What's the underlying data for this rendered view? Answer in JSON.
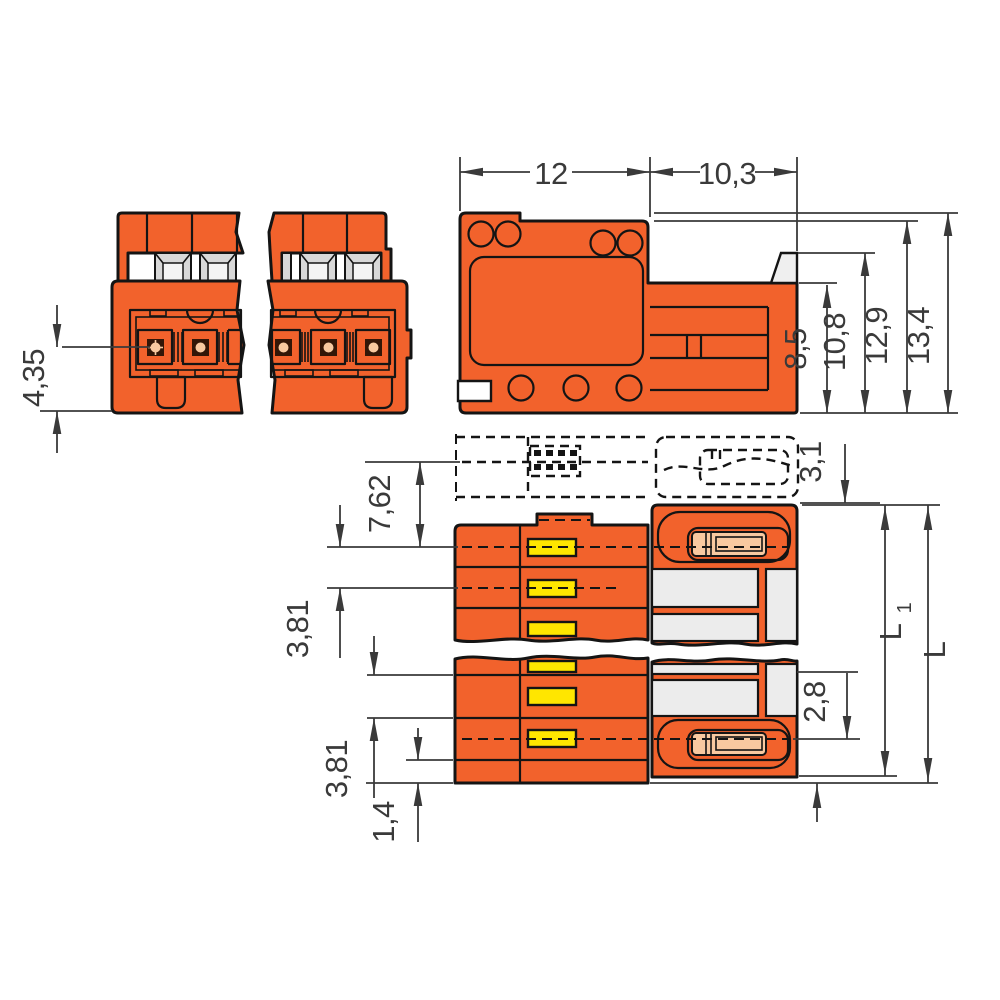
{
  "drawing": {
    "title": "Pluggable connector dimensional drawing",
    "dims": {
      "front_pin_depth": "4,35",
      "housing_width": "12",
      "extension_width": "10,3",
      "height_1": "8,5",
      "height_2": "10,8",
      "height_3": "12,9",
      "height_4": "13,4",
      "mating_clearance": "3,1",
      "edge_to_first_pole": "7,62",
      "pole_pitch_upper": "3,81",
      "pole_pitch_lower": "3,81",
      "foot_height": "1,4",
      "pin_offset": "2,8",
      "length_l1": "L",
      "length_l1_sub": "1",
      "length_l": "L"
    },
    "colors": {
      "body_orange": "#F2622C",
      "contact_yellow": "#FFE600",
      "pin_salmon": "#F8C9A0",
      "slot_gray": "#ECECEC",
      "button_gray": "#D8D8D8",
      "latch_gray": "#EFEFEF",
      "dark_contact": "#331607",
      "outline": "#141414",
      "dim_ink": "#3A3A3A"
    }
  }
}
